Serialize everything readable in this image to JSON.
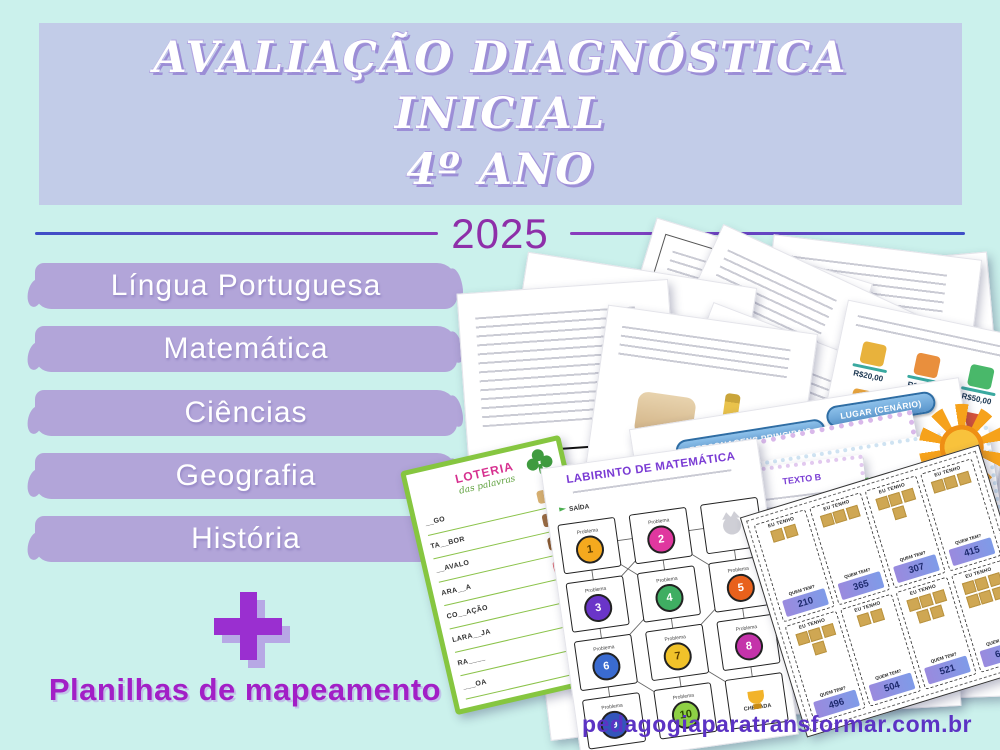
{
  "poster": {
    "background_color": "#cbf1ec",
    "banner": {
      "line1": "AVALIAÇÃO DIAGNÓSTICA",
      "line2": "INICIAL",
      "line3": "4º ANO",
      "bg_color": "#c2cce8",
      "text_color": "#ffffff",
      "shadow_color": "#9c8ed6"
    },
    "year": "2025",
    "year_color": "#8e2fa9",
    "subjects": [
      {
        "label": "Língua Portuguesa"
      },
      {
        "label": "Matemática"
      },
      {
        "label": "Ciências"
      },
      {
        "label": "Geografia"
      },
      {
        "label": "História"
      }
    ],
    "badge_color": "#b2a5d9",
    "plus": "+",
    "plus_color": "#9a2fd0",
    "extra_label": "Planilhas de mapeamento",
    "extra_color": "#a21fc6",
    "website": "pedagogiaparatransformar.com.br",
    "website_color": "#5c33c4"
  },
  "collage": {
    "loteria": {
      "title": "LOTERIA",
      "subtitle": "das palavras",
      "words": [
        "__GO",
        "TA__BOR",
        "__AVALO",
        "ARA__A",
        "CO__AÇÃO",
        "LARA__JA",
        "RA____",
        "___OA"
      ]
    },
    "labirinto": {
      "title": "LABIRINTO DE MATEMÁTICA",
      "start_label": "SAÍDA",
      "end_label": "CHEGADA",
      "box_label": "Problema",
      "numbers": [
        "1",
        "2",
        "3",
        "4",
        "5",
        "6",
        "7",
        "8",
        "9",
        "10"
      ]
    },
    "cards": {
      "have_label": "EU TENHO",
      "question_label": "QUEM TEM?",
      "numbers": [
        "210",
        "365",
        "307",
        "415",
        "496",
        "504",
        "521",
        "630"
      ]
    },
    "storymap": {
      "label_characters": "PERSONAGENS PRINCIPAIS",
      "label_place": "LUGAR (CENÁRIO)"
    },
    "detective": {
      "title": "DETETIVE DOS TEXTOS",
      "conclusion_label": "CONCLUSÃO",
      "texto_a": "TEXTO A",
      "texto_b": "TEXTO B"
    },
    "prices": [
      "R$20,00",
      "R$24,00",
      "R$50,00",
      "R$23,00",
      "R$7,00",
      "R$20,00"
    ],
    "digits": [
      "6",
      "5",
      "0",
      "8",
      "3",
      "4"
    ]
  }
}
